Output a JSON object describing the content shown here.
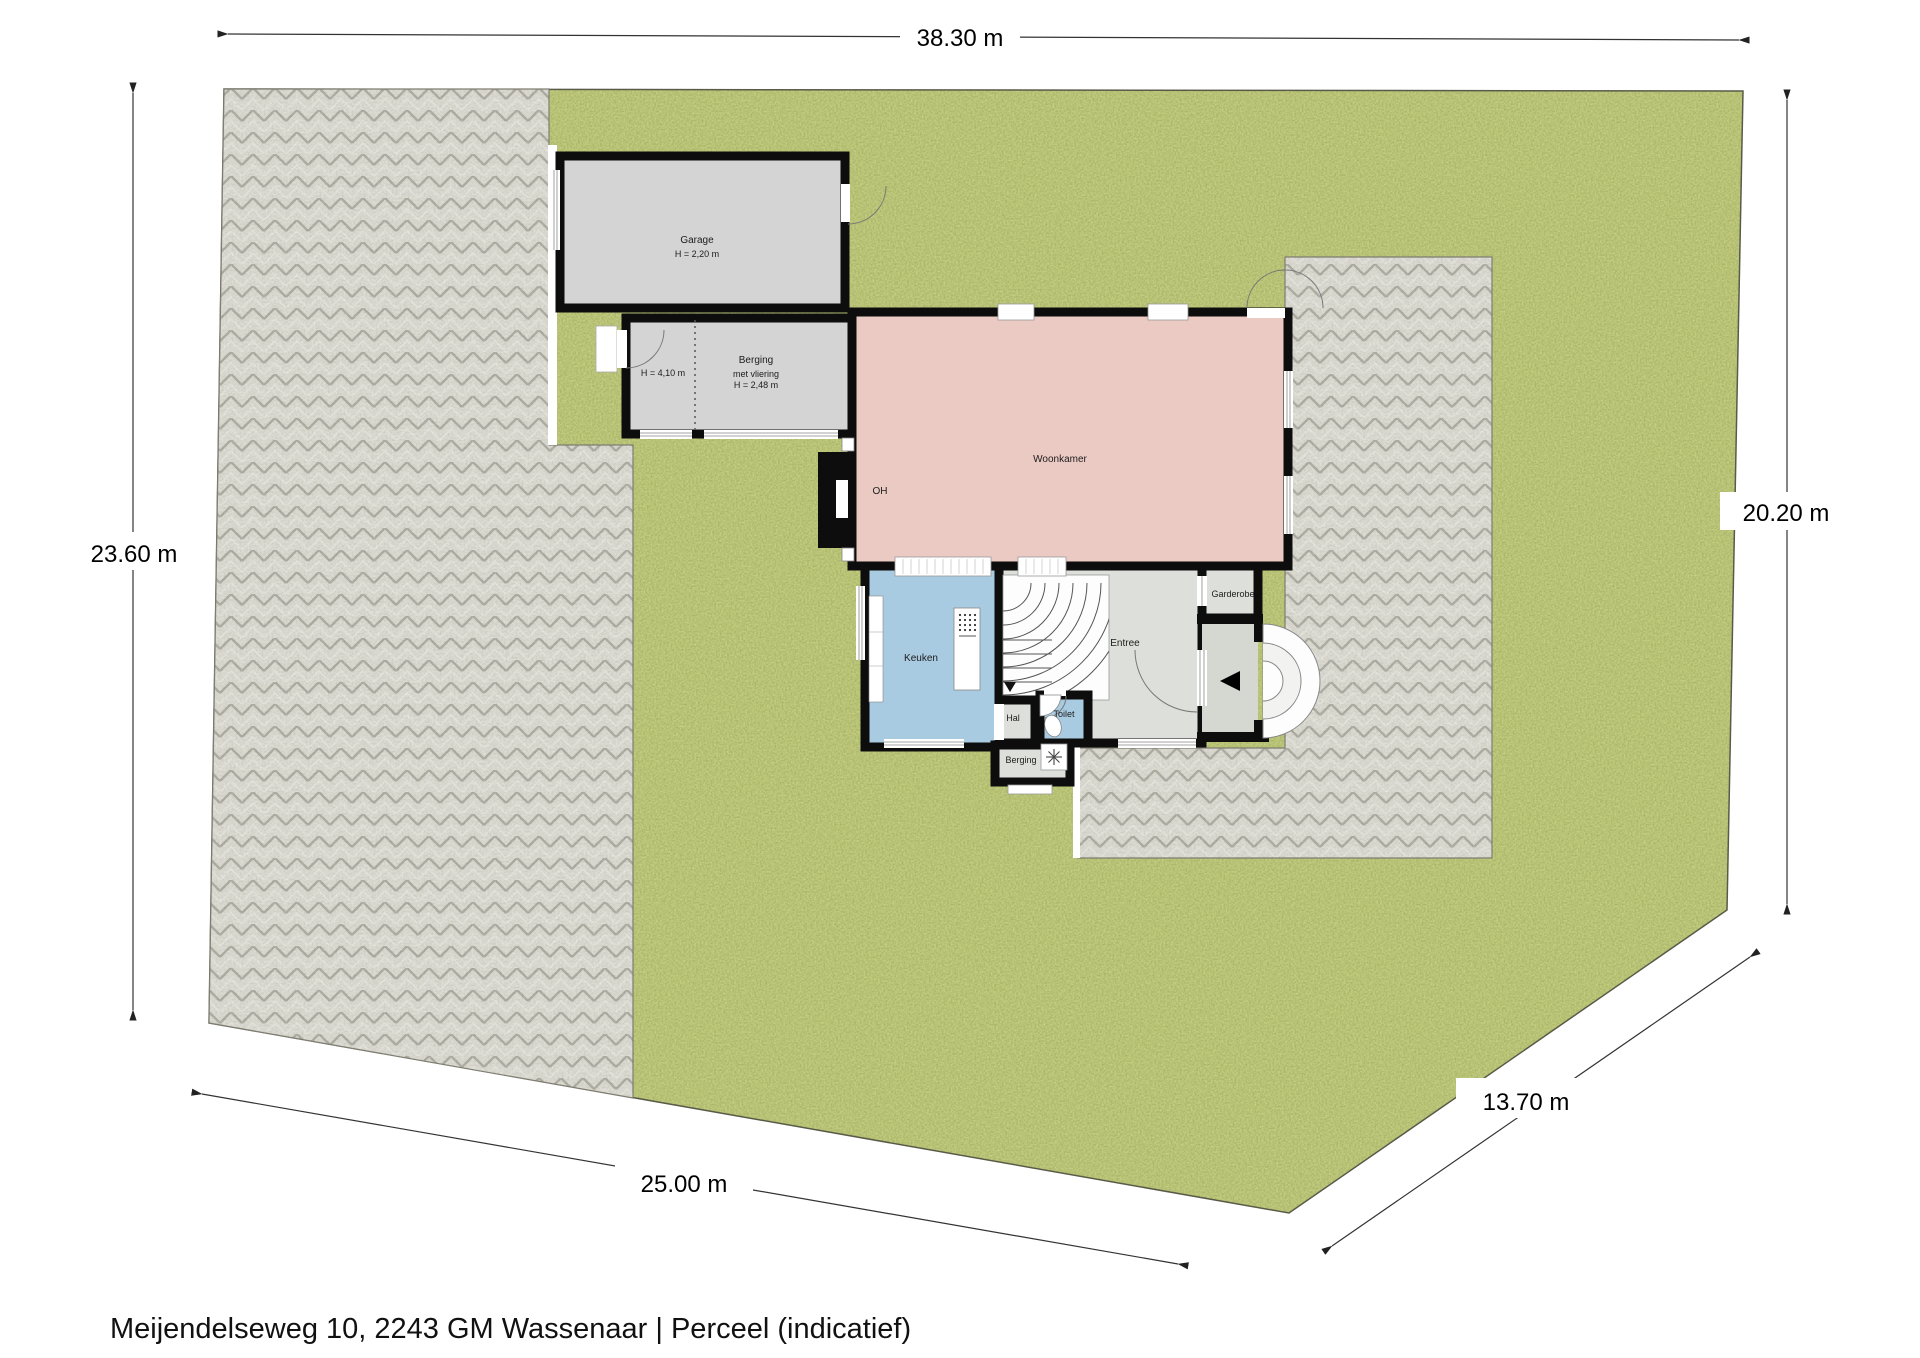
{
  "caption": "Meijendelseweg 10, 2243 GM Wassenaar | Perceel (indicatief)",
  "dimensions": {
    "top": "38.30 m",
    "left": "23.60 m",
    "right": "20.20 m",
    "bottom": "25.00 m",
    "diagonal": "13.70 m"
  },
  "rooms": {
    "garage": {
      "label": "Garage",
      "height": "H = 2,20 m"
    },
    "berging": {
      "label": "Berging",
      "note": "met vliering",
      "height": "H = 2,48 m",
      "left_height": "H = 4,10 m"
    },
    "woonkamer": {
      "label": "Woonkamer"
    },
    "fireplace": {
      "label": "OH"
    },
    "keuken": {
      "label": "Keuken"
    },
    "entree": {
      "label": "Entree"
    },
    "garderobe": {
      "label": "Garderobe"
    },
    "hal": {
      "label": "Hal"
    },
    "toilet": {
      "label": "Toilet"
    },
    "berging2": {
      "label": "Berging"
    }
  },
  "colors": {
    "grass": "#7d9143",
    "paving": "#b0ac9f",
    "wall": "#0d0d0d",
    "garage_fill": "#d4d4d4",
    "berging_fill": "#d4d4d4",
    "woonkamer_fill": "#eccac4",
    "keuken_fill": "#a9cbe1",
    "toilet_fill": "#a9cbe1",
    "entree_fill": "#dde0da",
    "hal_fill": "#dde0da",
    "garderobe_fill": "#dde0da",
    "berging2_fill": "#dde0da",
    "vestibule_fill": "#d5d7d1"
  }
}
